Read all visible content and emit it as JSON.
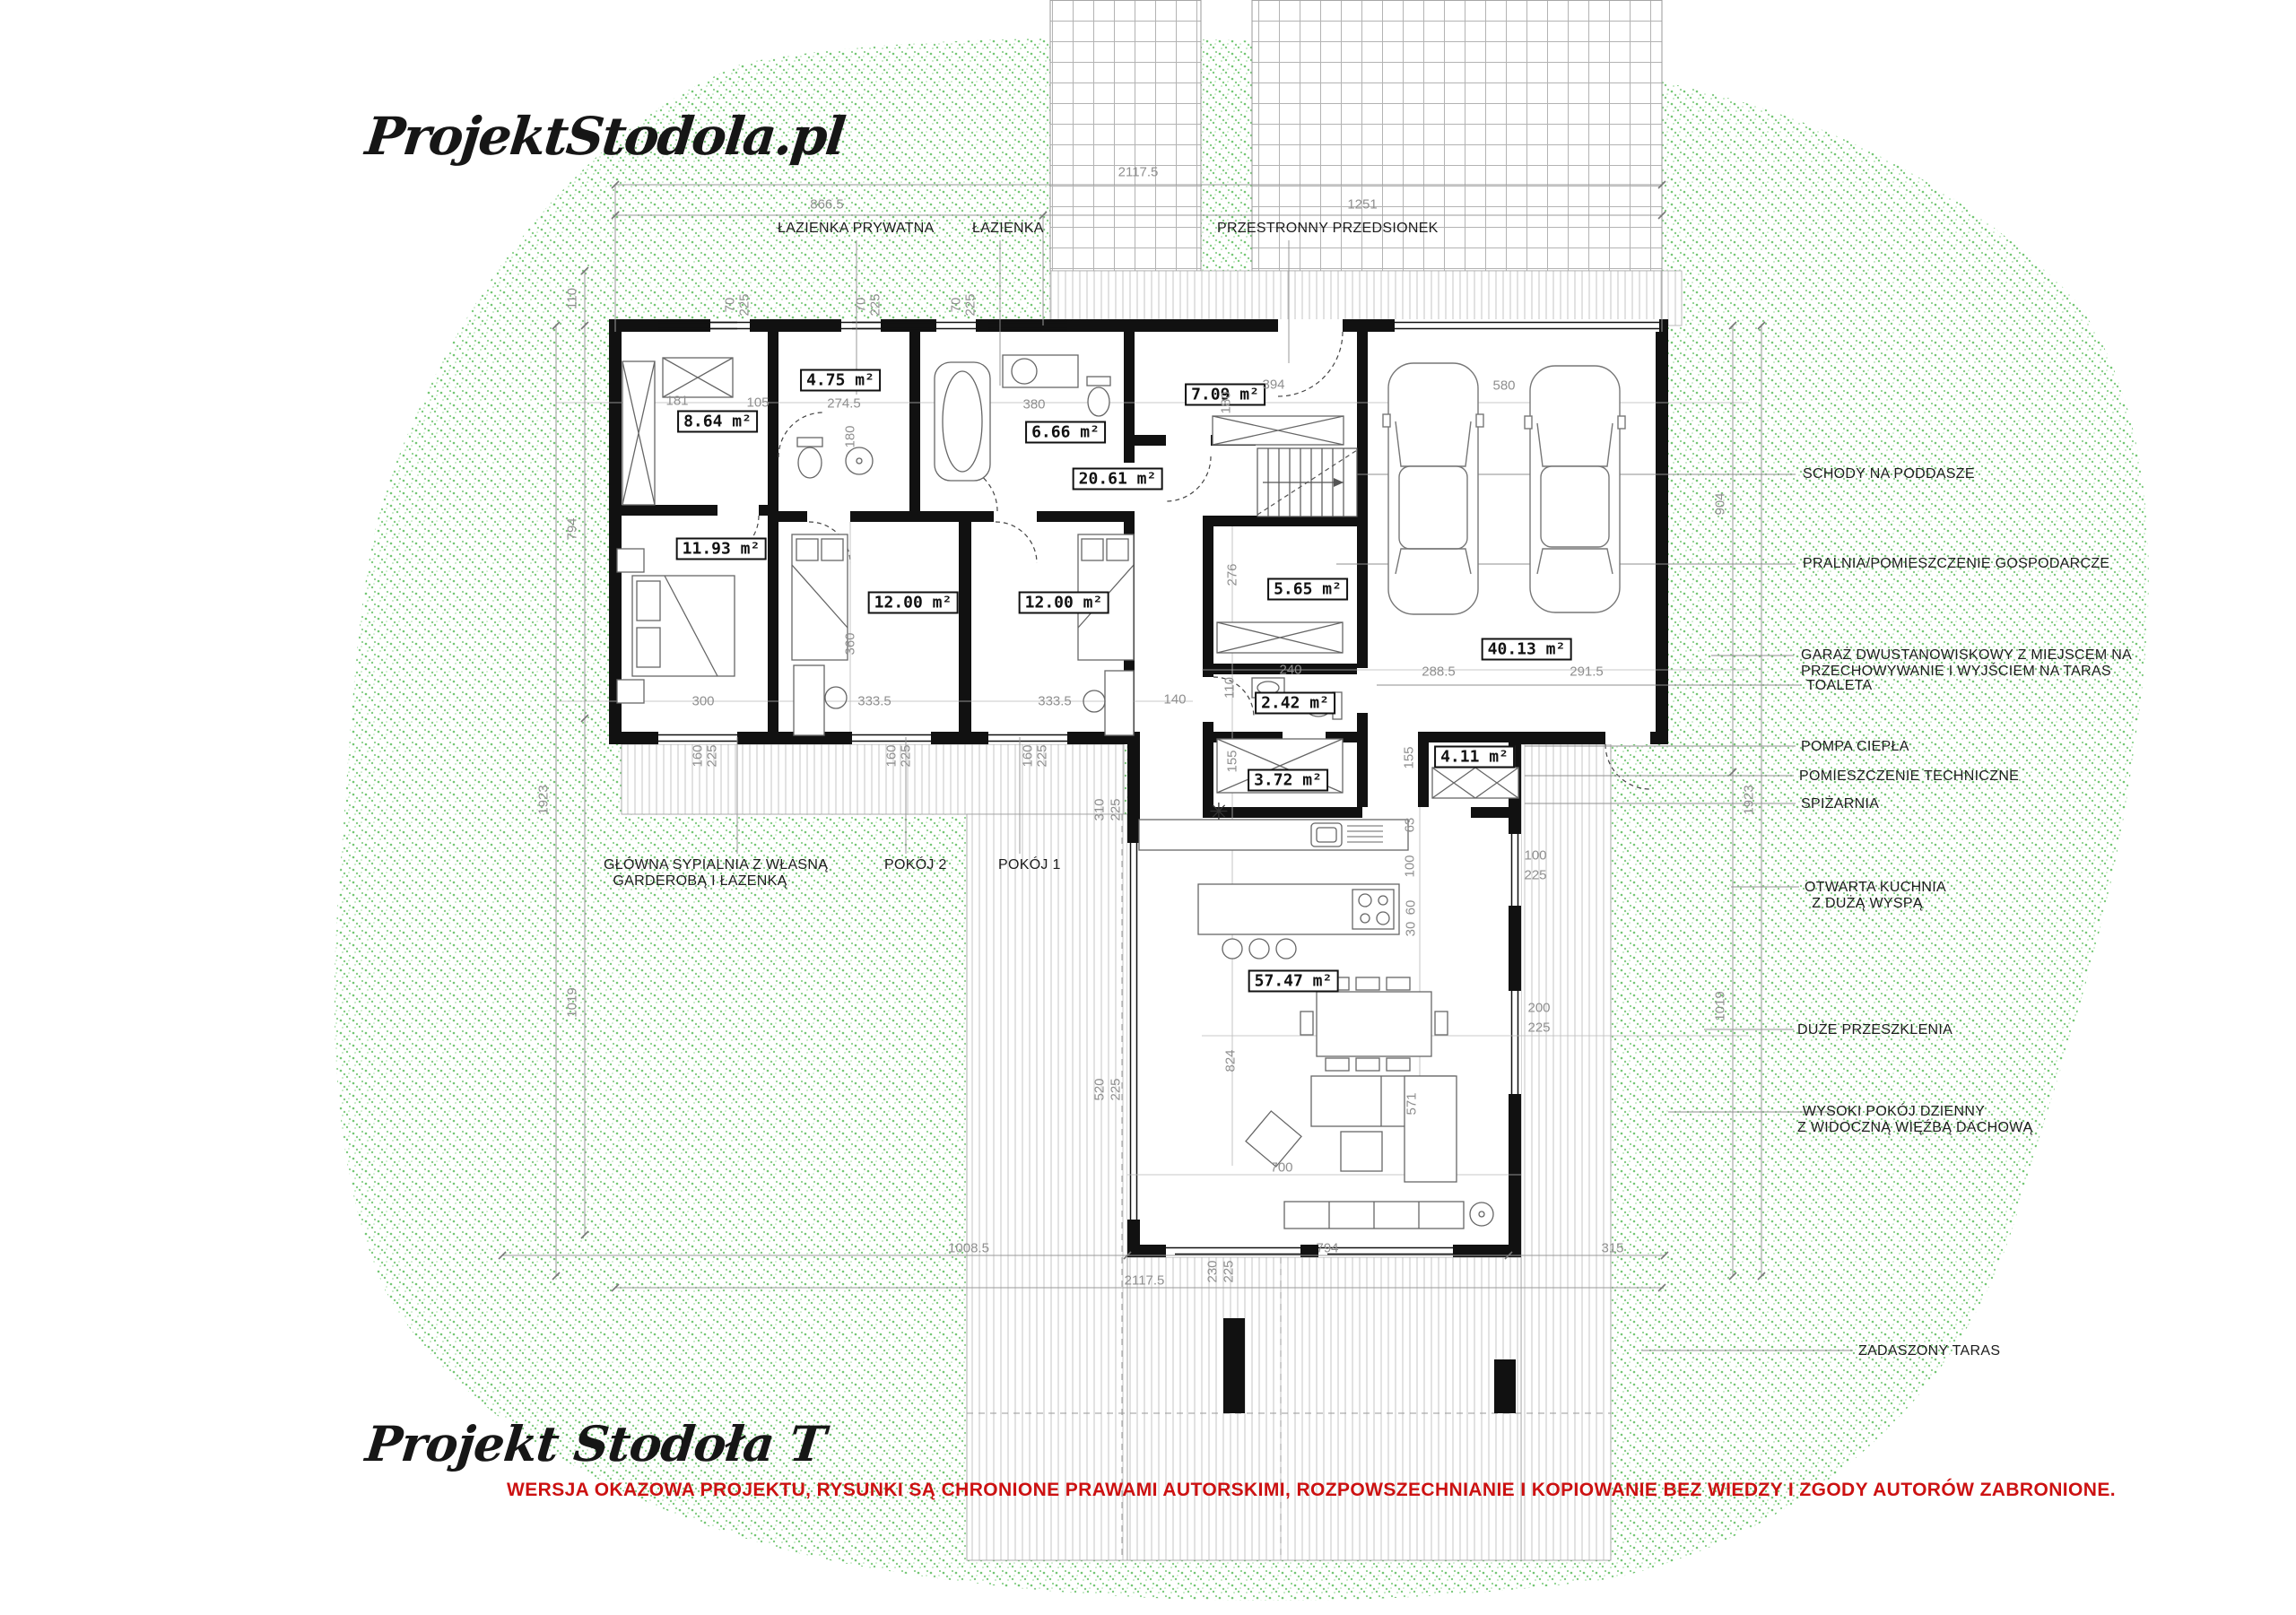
{
  "branding": {
    "logo_top": "ProjektStodola.pl",
    "logo_bottom": "Projekt Stodoła T",
    "copyright_notice": "WERSJA OKAZOWA PROJEKTU, RYSUNKI  SĄ CHRONIONE PRAWAMI AUTORSKIMI, ROZPOWSZECHNIANIE I KOPIOWANIE BEZ WIEDZY I ZGODY AUTORÓW ZABRONIONE."
  },
  "colors": {
    "copyright_red": "#cc1111",
    "site_speckle_green": "#5cbc5c",
    "wall_black": "#111111",
    "dimension_gray": "#8f8f8f"
  },
  "top_labels": [
    "ŁAZIENKA PRYWATNA",
    "ŁAZIENKA",
    "PRZESTRONNY PRZEDSIONEK"
  ],
  "bottom_labels": {
    "master": [
      "GŁÓWNA SYPIALNIA Z WŁASNĄ",
      "GARDEROBĄ I ŁAZENKĄ"
    ],
    "room2": "POKÓJ 2",
    "room1": "POKÓJ 1"
  },
  "callouts_right": [
    {
      "l1": "SCHODY NA PODDASZE"
    },
    {
      "l1": "PRALNIA/POMIESZCZENIE GOSPODARCZE"
    },
    {
      "l1": "GARAŻ DWUSTANOWISKOWY Z MIEJSCEM NA",
      "l2": "PRZECHOWYWANIE I WYJŚCIEM NA TARAS"
    },
    {
      "l1": "TOALETA"
    },
    {
      "l1": "POMPA CIEPŁA"
    },
    {
      "l1": "POMIESZCZENIE TECHNICZNE"
    },
    {
      "l1": "SPIŻARNIA"
    },
    {
      "l1": "OTWARTA KUCHNIA",
      "l2": "Z DUŻĄ WYSPĄ"
    },
    {
      "l1": "DUŻE PRZESZKLENIA"
    },
    {
      "l1": "WYSOKI POKÓJ DZIENNY",
      "l2": "Z WIDOCZNĄ WIĘŹBĄ DACHOWĄ"
    },
    {
      "l1": "ZADASZONY TARAS"
    }
  ],
  "rooms": [
    {
      "area": "8.64 m²"
    },
    {
      "area": "4.75 m²"
    },
    {
      "area": "6.66 m²"
    },
    {
      "area": "7.09 m²"
    },
    {
      "area": "20.61 m²"
    },
    {
      "area": "11.93 m²"
    },
    {
      "area": "12.00 m²"
    },
    {
      "area": "12.00 m²"
    },
    {
      "area": "5.65 m²"
    },
    {
      "area": "40.13 m²"
    },
    {
      "area": "2.42 m²"
    },
    {
      "area": "3.72 m²"
    },
    {
      "area": "4.11 m²"
    },
    {
      "area": "57.47 m²"
    }
  ],
  "dims": [
    "866.5",
    "2117.5",
    "1251",
    "110",
    "794",
    "1923",
    "1019",
    "904",
    "1923",
    "1019",
    "1008.5",
    "794",
    "315",
    "2117.5",
    "230",
    "225",
    "181",
    "105",
    "274.5",
    "180",
    "380",
    "70",
    "225",
    "70",
    "225",
    "70",
    "225",
    "300",
    "360",
    "333.5",
    "333.5",
    "140",
    "160",
    "225",
    "160",
    "225",
    "160",
    "225",
    "394",
    "180",
    "580",
    "276",
    "240",
    "110",
    "288.5",
    "291.5",
    "155",
    "155",
    "63",
    "100",
    "60",
    "30",
    "100",
    "225",
    "200",
    "225",
    "310",
    "225",
    "520",
    "225",
    "824",
    "571",
    "700"
  ],
  "symbols": {
    "kitchen_star": "✳"
  }
}
